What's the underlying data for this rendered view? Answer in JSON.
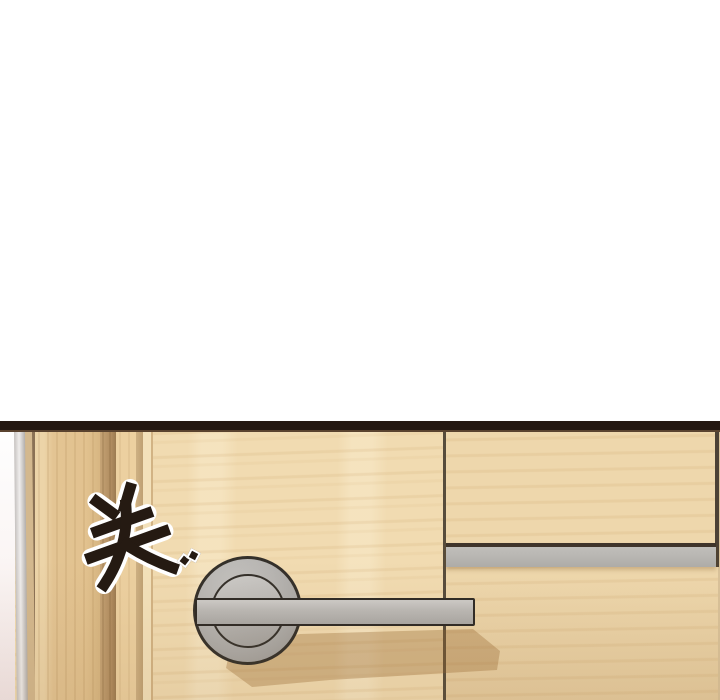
{
  "panel": {
    "kind": "webtoon-comic-panel",
    "sfx": {
      "text": "关",
      "fill": "#251a12",
      "outline": "#ffffff"
    }
  },
  "colors": {
    "page_bg": "#ffffff",
    "top_bar": "#241812",
    "top_bar_edge": "#5a432f",
    "wood_main": "#f1dbb1",
    "wood_right": "#eed7ac",
    "frame_shadow": "#d3b88e",
    "frame_dark_line": "#8a7155",
    "seam": "#574c3c",
    "metal_outline": "#34302a",
    "shadow": "rgba(148,101,47,0.33)",
    "sfx_fill": "#251a12",
    "sfx_outline": "#ffffff"
  }
}
